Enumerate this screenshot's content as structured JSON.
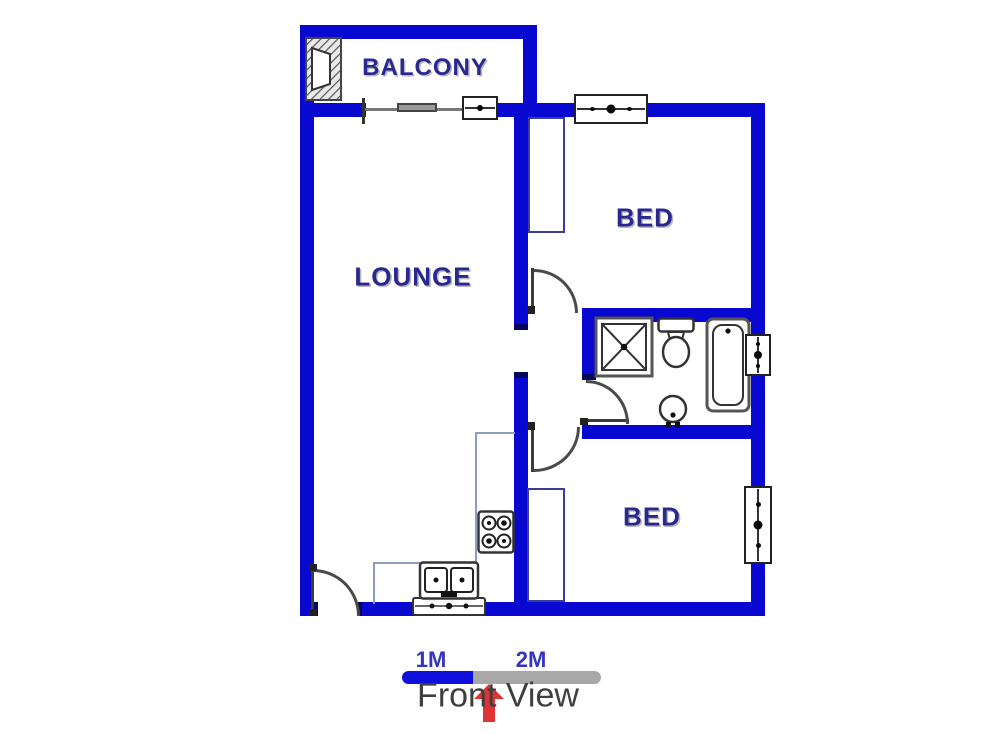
{
  "colors": {
    "wall": "#0808d0",
    "wall_dark": "#06065a",
    "label": "#28288f",
    "counter": "#8d9dc2",
    "wardrobe": "#3c3c9c",
    "scale_blue": "#1010dc",
    "scale_gray": "#a8a8a8",
    "scale_label": "#3434c0",
    "view_text": "#3f3f3f",
    "arrow_red": "#df3232"
  },
  "rooms": {
    "balcony": "BALCONY",
    "lounge": "LOUNGE",
    "bed_top": "BED",
    "bed_bottom": "BED"
  },
  "scale_bar": {
    "label_1m": "1M",
    "label_2m": "2M"
  },
  "view": {
    "label": "Front View"
  },
  "symbols": [
    "braai-hatch-icon",
    "sliding-door-icon",
    "window-icon",
    "door-swing-icon",
    "shower-icon",
    "toilet-icon",
    "bathtub-icon",
    "basin-icon",
    "stove-icon",
    "double-sink-icon",
    "wardrobe-outline",
    "kitchen-counter-outline",
    "scale-bar",
    "front-view-arrow-icon"
  ]
}
